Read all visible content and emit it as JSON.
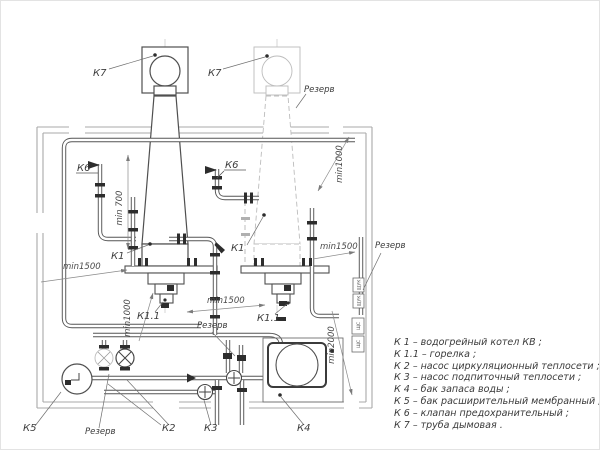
{
  "labels": {
    "k7": "К7",
    "k6": "К6",
    "k1": "К1",
    "k1_1": "К1.1",
    "k2": "К2",
    "k3": "К3",
    "k4": "К4",
    "k5": "К5",
    "reserve": "Резерв"
  },
  "dimensions": {
    "min700": "min 700",
    "min1000": "min1000",
    "min1500": "min1500",
    "min2000": "min2000"
  },
  "cabinets": {
    "panel_a": "ЩУК",
    "panel_b": "ЩС"
  },
  "legend": {
    "items": [
      "К 1 –  водогрейный котел КВ ;",
      "К 1.1 –  горелка ;",
      "К 2 –  насос циркуляционный теплосети ;",
      "К 3 –  насос подпиточный теплосети ;",
      "К 4 –  бак запаса воды ;",
      "К 5 –  бак расширительный мембранный ;",
      "К 6 –  клапан предохранительный ;",
      "К 7 –  труба дымовая ."
    ]
  },
  "colors": {
    "line": "#4f4f4f",
    "reserve_line": "#bcbcbc",
    "text": "#3a3a3a"
  }
}
